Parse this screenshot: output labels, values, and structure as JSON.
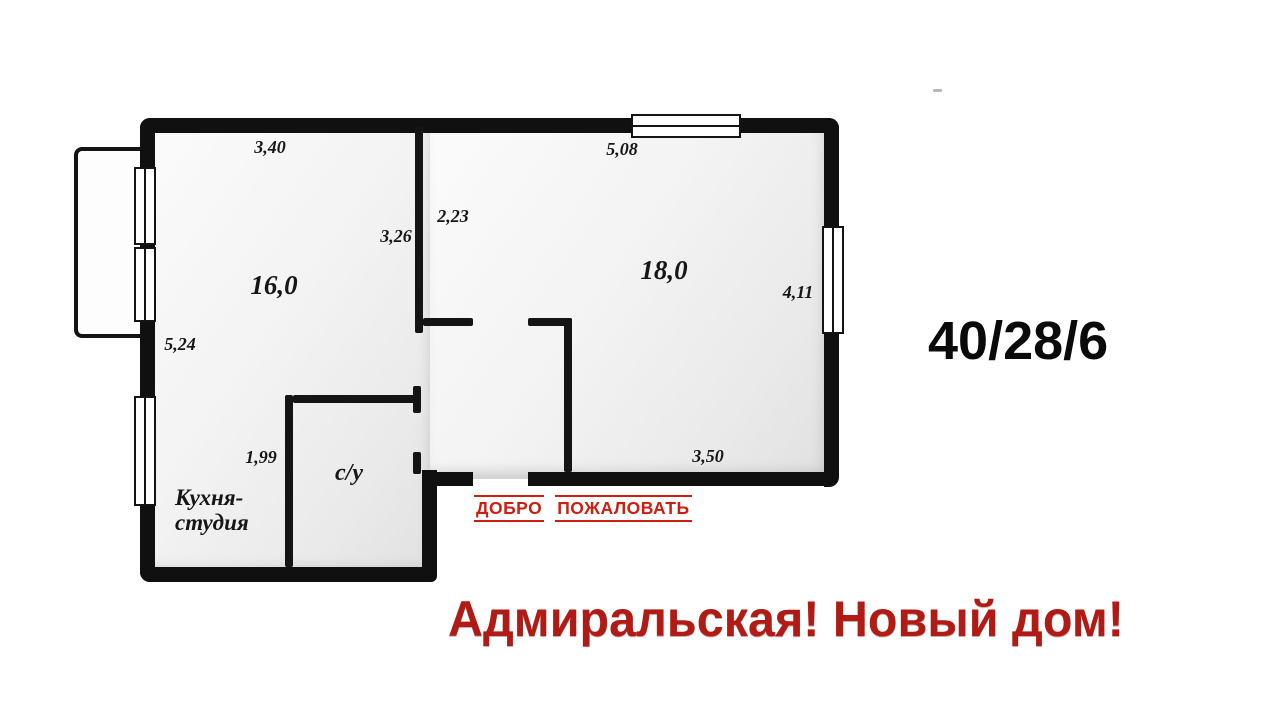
{
  "poster": {
    "spec": "40/28/6",
    "tagline": "Адмиральская! Новый дом!",
    "welcome": {
      "word1": "ДОБРО",
      "word2": "ПОЖАЛОВАТЬ"
    }
  },
  "floorplan": {
    "rooms": {
      "living_area": "16,0",
      "bedroom_area": "18,0",
      "bathroom": "с/у",
      "kitchen_line1": "Кухня-",
      "kitchen_line2": "студия"
    },
    "dimensions": {
      "top_left_wall": "3,40",
      "top_right_wall": "5,08",
      "corridor_width": "2,23",
      "corridor_wall": "3,26",
      "right_wall": "4,11",
      "left_wall": "5,24",
      "bathroom_width": "1,99",
      "bottom_wall": "3,50"
    }
  },
  "colors": {
    "wall": "#101010",
    "welcome_red": "#ce1e0f",
    "tagline_red": "#b01b15",
    "room_fill_light": "#fbfbfb",
    "room_fill_dark": "#e0e0e0"
  }
}
